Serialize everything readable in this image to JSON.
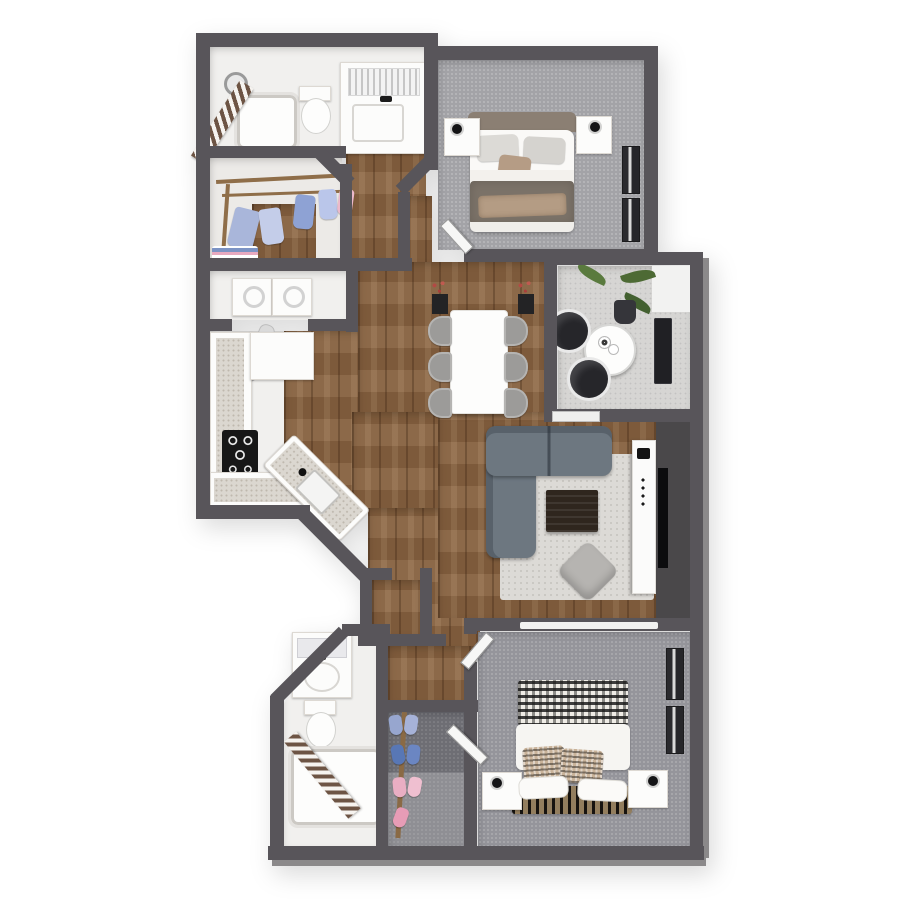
{
  "meta": {
    "kind": "3d-floor-plan-render",
    "style": "top-down dollhouse view",
    "background": "#ffffff"
  },
  "palette": {
    "wall": "#58555a",
    "wallFace": "#8b898a",
    "wood": "#86613f",
    "tile": "#f1f0ee",
    "carpet": "#a3a3a7",
    "carpetBedroom2": "#95959b",
    "carpetCloset": "#6e6e74",
    "concrete": "#d6d5d3",
    "counterWhite": "#fcfcfb",
    "countertopSpeckle": "#dbd7d0",
    "sofa": "#6d7780",
    "rug": "#dcdad6",
    "coffeeTable": "#2f261e",
    "black": "#141416",
    "headboardTan": "#8b7f73",
    "duvetTaupe": "#7b7268",
    "throwTan": "#b49c84",
    "plantGreen": "#4d6a34",
    "shirtBlue": "#a9b6da",
    "shirtBlueDark": "#5877b5",
    "shirtPink": "#ecb9cb"
  },
  "rooms": [
    {
      "id": "bathroom-1",
      "name": "primary-bathroom",
      "floor": "tile",
      "furniture": [
        "bathtub",
        "shower-head",
        "striped-shower-curtain",
        "toilet",
        "vanity-sink",
        "towel-mirror"
      ]
    },
    {
      "id": "walk-in-closet",
      "name": "walk-in-closet",
      "floor": "wood",
      "furniture": [
        "clothes-rods",
        "hanging-shirts",
        "folded-clothes-pile"
      ]
    },
    {
      "id": "bedroom-1",
      "name": "bedroom-top",
      "floor": "carpet",
      "furniture": [
        "bed",
        "headboard",
        "pillows",
        "duvet",
        "nightstand-left",
        "nightstand-right",
        "lamps",
        "windows",
        "door"
      ]
    },
    {
      "id": "laundry-closet",
      "name": "laundry-closet",
      "floor": "tile",
      "furniture": [
        "washer",
        "dryer",
        "ironing-board"
      ]
    },
    {
      "id": "kitchen",
      "name": "kitchen",
      "floor": "wood",
      "furniture": [
        "cabinet-run-left",
        "upper-cabinet-block",
        "cooktop",
        "counter-bottom",
        "sink-peninsula"
      ]
    },
    {
      "id": "dining",
      "name": "dining-area",
      "floor": "wood",
      "furniture": [
        "dining-table",
        "chairs-x6",
        "plant-stand-left",
        "plant-stand-right"
      ]
    },
    {
      "id": "patio",
      "name": "patio",
      "floor": "concrete",
      "furniture": [
        "bistro-table",
        "coffee-cups",
        "chair-x2",
        "potted-palm",
        "storage-console"
      ]
    },
    {
      "id": "living",
      "name": "living-room",
      "floor": "wood",
      "furniture": [
        "sectional-sofa",
        "area-rug",
        "coffee-table",
        "floor-pillow",
        "tv-console",
        "media-wall",
        "tv"
      ]
    },
    {
      "id": "bedroom-2",
      "name": "bedroom-bottom",
      "floor": "carpet",
      "furniture": [
        "bed",
        "plaid-blanket",
        "duvet",
        "checkered-pillows",
        "white-pillows",
        "slat-headboard",
        "nightstand-left",
        "nightstand-right",
        "lamps",
        "windows",
        "door",
        "closet-track"
      ]
    },
    {
      "id": "bathroom-2",
      "name": "bathroom-bottom",
      "floor": "tile",
      "furniture": [
        "vanity-sink",
        "mirror",
        "toilet",
        "bathtub",
        "striped-shower-curtain"
      ]
    },
    {
      "id": "shoe-closet",
      "name": "shoe-closet",
      "floor": "carpet-dark",
      "furniture": [
        "shoe-rack-pole",
        "shoes-blue",
        "shoes-pink",
        "door"
      ]
    },
    {
      "id": "entry-vestibule",
      "name": "entry-nook",
      "floor": "wood",
      "furniture": []
    }
  ]
}
